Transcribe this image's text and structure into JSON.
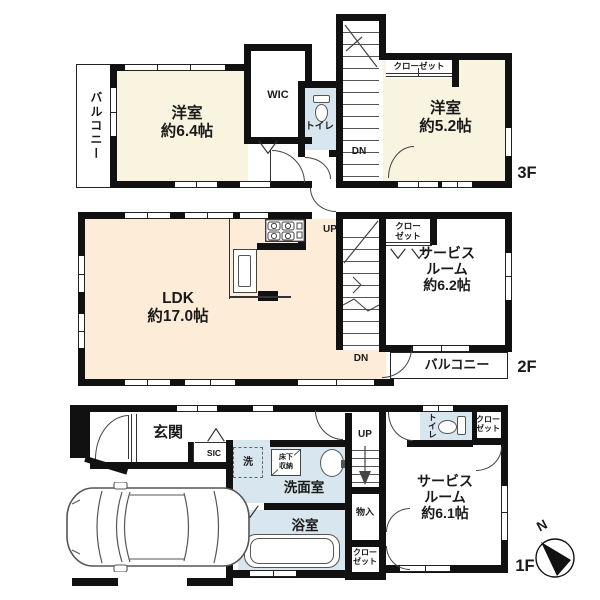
{
  "colors": {
    "wall": "#111111",
    "line": "#333333",
    "cream": "#f8f4e0",
    "ldk": "#fcecd8",
    "blue": "#d8e6f0",
    "white": "#ffffff",
    "text": "#1a1a1a",
    "bg": "#ffffff"
  },
  "f3": {
    "floor_label": "3F",
    "balcony": "バルコニー",
    "room1_name": "洋室",
    "room1_size": "約6.4帖",
    "wic": "WIC",
    "toilet": "トイレ",
    "dn": "DN",
    "closet": "クローゼット",
    "room2_name": "洋室",
    "room2_size": "約5.2帖"
  },
  "f2": {
    "floor_label": "2F",
    "ldk_name": "LDK",
    "ldk_size": "約17.0帖",
    "up": "UP",
    "dn": "DN",
    "closet_line1": "クロー",
    "closet_line2": "ゼット",
    "service_line1": "サービス",
    "service_line2": "ルーム",
    "service_size": "約6.2帖",
    "balcony": "バルコニー"
  },
  "f1": {
    "floor_label": "1F",
    "entrance": "玄関",
    "sic": "SIC",
    "laundry": "洗",
    "floor_storage_line1": "床下",
    "floor_storage_line2": "収納",
    "washroom": "洗面室",
    "bathroom": "浴室",
    "up": "UP",
    "storage": "物入",
    "closet_line1": "クロー",
    "closet_line2": "ゼット",
    "toilet": "トイレ",
    "closet2_line1": "クロー",
    "closet2_line2": "ゼット",
    "service_line1": "サービス",
    "service_line2": "ルーム",
    "service_size": "約6.1帖",
    "compass_north": "N"
  }
}
